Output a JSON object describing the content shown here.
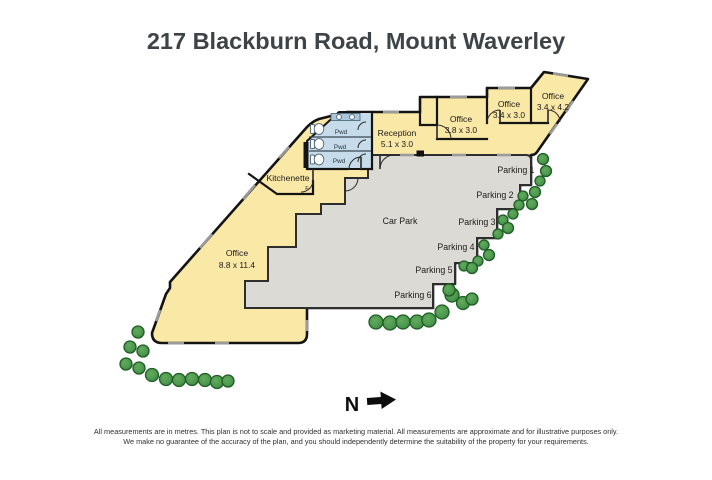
{
  "title": "217 Blackburn Road, Mount Waverley",
  "plan": {
    "rooms": {
      "main_office": {
        "label": "Office",
        "dims": "8.8 x 11.4"
      },
      "kitchenette": {
        "label": "Kitchenette",
        "appliance": "F"
      },
      "reception": {
        "label": "Reception",
        "dims": "5.1 x 3.0"
      },
      "office_a": {
        "label": "Office",
        "dims": "3.8 x 3.0"
      },
      "office_b": {
        "label": "Office",
        "dims": "3.4 x 3.0"
      },
      "office_c": {
        "label": "Office",
        "dims": "3.4 x 4.2"
      },
      "powder_1": "Pwd",
      "powder_2": "Pwd",
      "powder_3": "Pwd"
    },
    "carpark": {
      "label": "Car Park",
      "spaces": [
        "Parking 1",
        "Parking 2",
        "Parking 3",
        "Parking 4",
        "Parking 5",
        "Parking 6"
      ]
    },
    "compass": "N"
  },
  "disclaimer": {
    "line1": "All measurements are in metres. This plan is not to scale and provided as marketing material. All measurements are approximate and for illustrative purposes only.",
    "line2": "We make no guarantee of the accuracy of the plan, and you should independently determine the suitability of the property for your requirements."
  },
  "colors": {
    "building": "#FAE8A7",
    "carpark": "#DCDAD4",
    "tiles": "#C7DCEA",
    "wall": "#141414"
  }
}
